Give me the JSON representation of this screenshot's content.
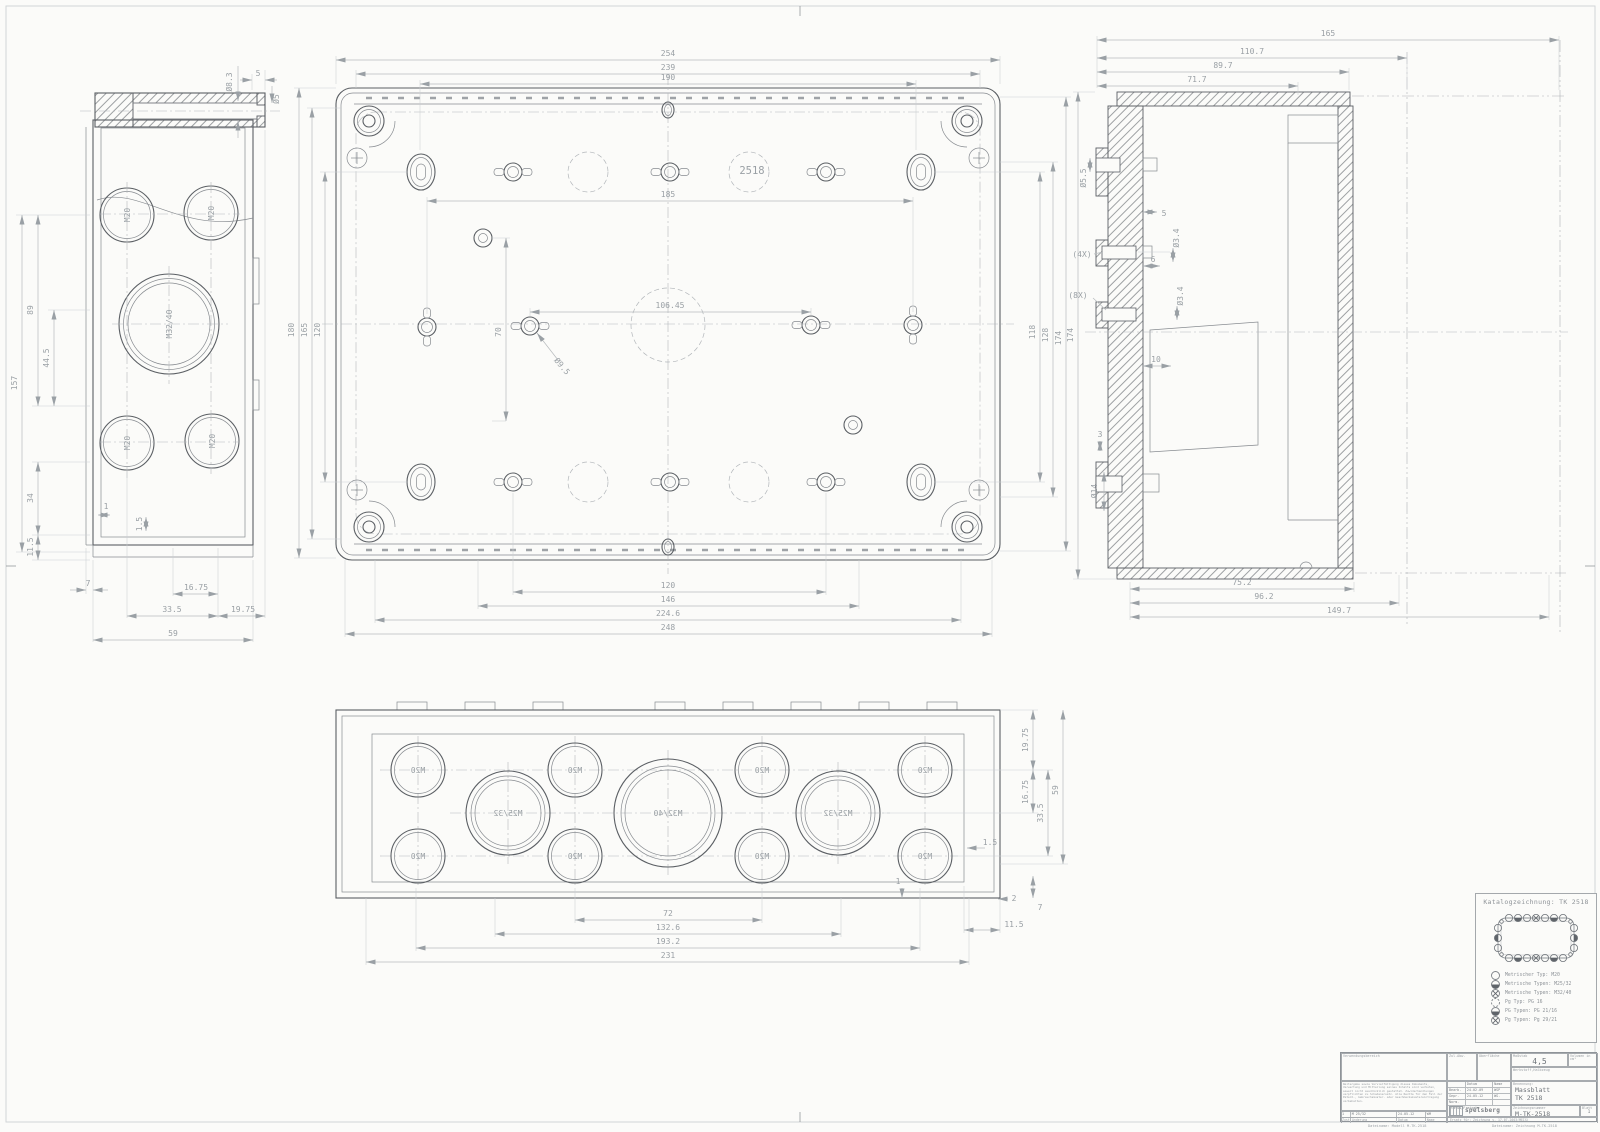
{
  "knockouts": {
    "m20": "M20",
    "m25_32": "M25/32",
    "m32_40": "M32/40"
  },
  "left_view": {
    "dims": {
      "d8_3": "Ø8.3",
      "n5": "5",
      "d5": "Ø5",
      "v157": "157",
      "v89": "89",
      "v44_5": "44.5",
      "v34": "34",
      "v11_5": "11.5",
      "n7": "7",
      "n16_75": "16.75",
      "n33_5": "33.5",
      "n19_75": "19.75",
      "n59": "59",
      "n1": "1",
      "n1_5": "1.5"
    }
  },
  "plan_view": {
    "labels": {
      "part_no": "2518"
    },
    "dims": {
      "t254": "254",
      "t239": "239",
      "t190": "190",
      "m185": "185",
      "m106_45": "106.45",
      "v70": "70",
      "d9_5": "Ø9.5",
      "l180": "180",
      "l165": "165",
      "l120": "120",
      "r118": "118",
      "r128": "128",
      "r174": "174",
      "b120": "120",
      "b146": "146",
      "b224_6": "224.6",
      "b248": "248"
    }
  },
  "section_view": {
    "dims": {
      "t165": "165",
      "t110_7": "110.7",
      "t89_7": "89.7",
      "t71_7": "71.7",
      "d5_5": "Ø5.5",
      "n5": "5",
      "x4": "(4X)",
      "d3_4": "Ø3.4",
      "n6": "6",
      "x8": "(8X)",
      "d3_4b": "Ø3.4",
      "n10": "10",
      "n3": "3",
      "d14": "Ø14",
      "v174": "174",
      "b75_2": "75.2",
      "b96_2": "96.2",
      "b149_7": "149.7"
    }
  },
  "front_view": {
    "dims": {
      "v19_75": "19.75",
      "v16_75": "16.75",
      "v33_5": "33.5",
      "v59": "59",
      "n1_5": "1.5",
      "n1": "1",
      "n7": "7",
      "n2": "2",
      "n11_5": "11.5",
      "b72": "72",
      "b132_6": "132.6",
      "b193_2": "193.2",
      "b231": "231"
    }
  },
  "legend": {
    "title": "Katalogzeichnung: TK 2518",
    "items": [
      {
        "symbol": "circle",
        "label": "Metrischer Typ: M20"
      },
      {
        "symbol": "half-circle",
        "label": "Metrische Typen: M25/32"
      },
      {
        "symbol": "crossed-circle",
        "label": "Metrische Typen: M32/40"
      },
      {
        "symbol": "dashed-circle",
        "label": "Pg Typ: PG 16"
      },
      {
        "symbol": "half-circle",
        "label": "PG Typen: PG 21/16"
      },
      {
        "symbol": "crossed-circle",
        "label": "Pg Typen: Pg 29/21"
      }
    ]
  },
  "title_block": {
    "verwendungsbereich": "Verwendungsbereich",
    "zul_abw": "Zul.Abw.",
    "oberflaeche": "Oberfläche",
    "massstab_label": "Maßstab",
    "massstab_value": "4,5",
    "volumen": "Volumen in cm³",
    "werkstoff": "Werkstoff,Halbzeug",
    "legal": "Weitergabe sowie Vervielfältigung dieses Dokuments, Verwertung und Mitteilung seines Inhalts sind verboten, soweit nicht ausdrücklich gestattet. Zuwiderhandlungen verpflichten zu Schadenersatz. Alle Rechte für den Fall der Patent-, Gebrauchsmuster- oder Geschmacksmustereintragung vorbehalten.",
    "datum_label": "Datum",
    "name_label": "Name",
    "bearb_label": "Bearb.",
    "bearb_datum": "24.02.09",
    "bearb_name": "WSP",
    "gepr_label": "Gepr.",
    "gepr_datum": "24.05.12",
    "gepr_name": "WG.",
    "norm_label": "Norm.",
    "status_label": "Status/Freigabe",
    "logo": "spelsberg",
    "benennung_label": "Benennung:",
    "benennung1": "Massblatt",
    "benennung2": "TK 2518",
    "zeichnung_label": "Zeichnungsnummer",
    "zeichnung_nr": "M-TK-2518",
    "blatt_label": "Blatt",
    "blatt_value": "1",
    "bl_value": "1 Bl.",
    "ersatz": "Ersatz für: Zeichnung v. 17.07.2003(MEIS)",
    "rev_zust": "1",
    "rev_text": "M 25/32",
    "rev_datum": "24.05.12",
    "rev_name": "WM",
    "zust_label": "Zust.",
    "aenderung_label": "Änderung",
    "datum2_label": "Datum",
    "name2_label": "Name"
  },
  "footer": {
    "file_model": "Dateiname: Modell M-TK-2518",
    "file_drawing": "Dateiname: Zeichnung M-TK-2518"
  }
}
